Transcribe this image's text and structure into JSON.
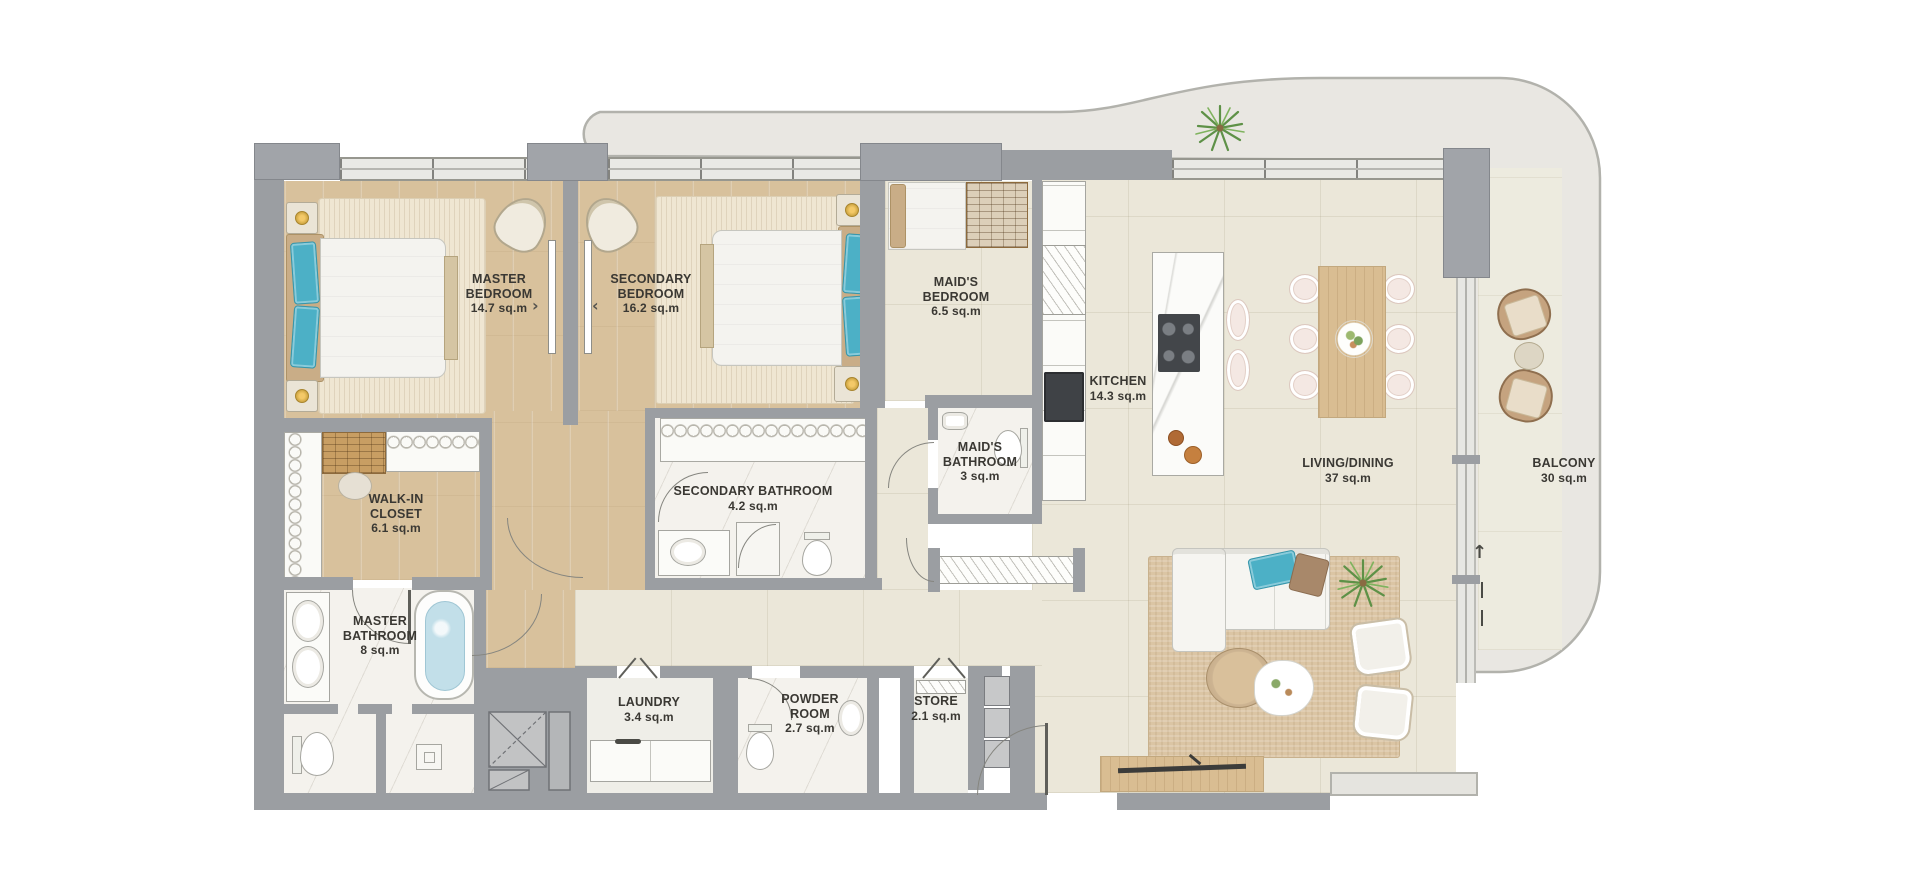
{
  "rooms": {
    "master_bedroom": {
      "l1": "MASTER",
      "l2": "BEDROOM",
      "area": "14.7 sq.m"
    },
    "secondary_bedroom": {
      "l1": "SECONDARY",
      "l2": "BEDROOM",
      "area": "16.2 sq.m"
    },
    "maids_bedroom": {
      "l1": "MAID'S",
      "l2": "BEDROOM",
      "area": "6.5 sq.m"
    },
    "kitchen": {
      "l1": "KITCHEN",
      "area": "14.3 sq.m"
    },
    "maids_bathroom": {
      "l1": "MAID'S",
      "l2": "BATHROOM",
      "area": "3 sq.m"
    },
    "secondary_bathroom": {
      "l1": "SECONDARY BATHROOM",
      "area": "4.2 sq.m"
    },
    "walk_in_closet": {
      "l1": "WALK-IN",
      "l2": "CLOSET",
      "area": "6.1 sq.m"
    },
    "master_bathroom": {
      "l1": "MASTER",
      "l2": "BATHROOM",
      "area": "8 sq.m"
    },
    "laundry": {
      "l1": "LAUNDRY",
      "area": "3.4 sq.m"
    },
    "powder_room": {
      "l1": "POWDER",
      "l2": "ROOM",
      "area": "2.7 sq.m"
    },
    "store": {
      "l1": "STORE",
      "area": "2.1 sq.m"
    },
    "living_dining": {
      "l1": "LIVING/DINING",
      "area": "37 sq.m"
    },
    "balcony": {
      "l1": "BALCONY",
      "area": "30 sq.m"
    }
  },
  "markers": {
    "balcony_direction_arrow": "↑"
  },
  "colors": {
    "wall": "#9b9ea2",
    "wood_floor": "#d8c19c",
    "tile_floor": "#ebe7d9",
    "marble_floor": "#f4f2ed",
    "balcony_floor": "#edebdf",
    "canopy_band": "#e9e7e2",
    "accent_blue": "#4cb0c6",
    "rug": "#d9c3a2",
    "plant_green": "#5e9147"
  }
}
